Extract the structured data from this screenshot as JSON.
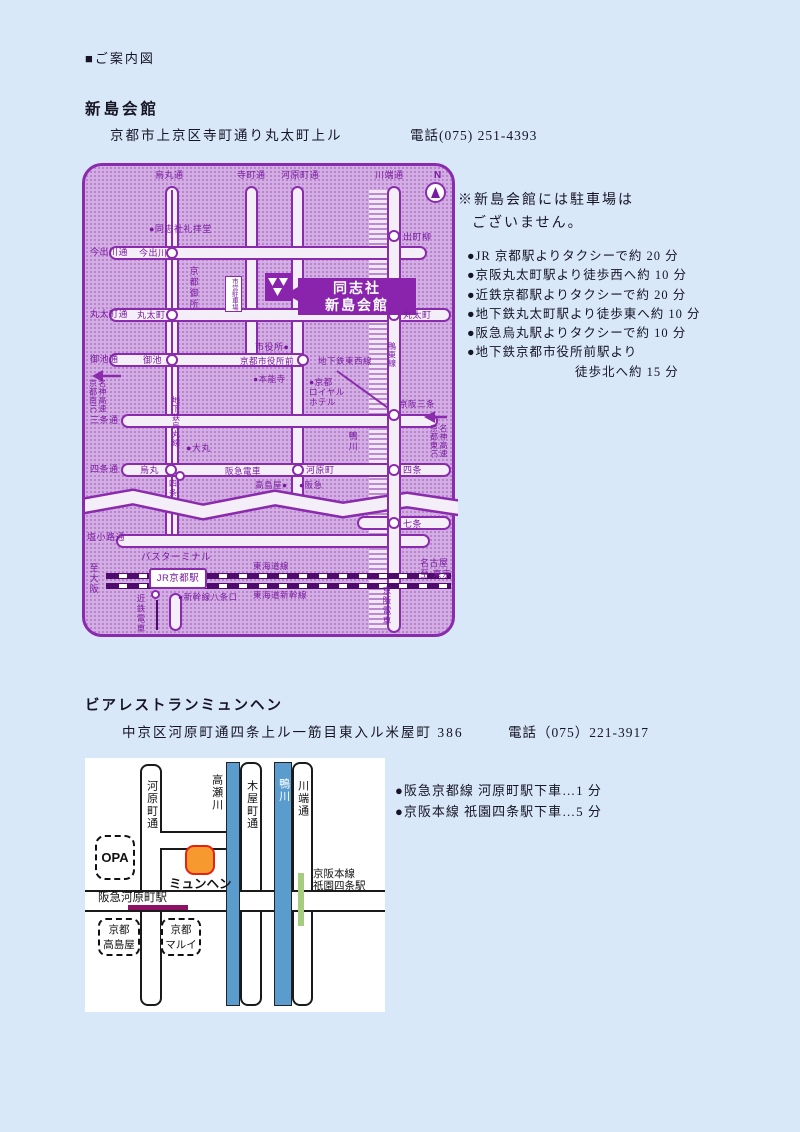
{
  "doc": {
    "heading": "■ご案内図",
    "s1_title": "新島会館",
    "s1_address": "京都市上京区寺町通り丸太町上ル",
    "s1_phone": "電話(075) 251-4393",
    "s1_note1": "※新島会館には駐車場は",
    "s1_note2": "ございません。",
    "s1_access": [
      "●JR 京都駅よりタクシーで約 20 分",
      "●京阪丸太町駅より徒歩西へ約 10 分",
      "●近鉄京都駅よりタクシーで約 20 分",
      "●地下鉄丸太町駅より徒歩東へ約 10 分",
      "●阪急烏丸駅よりタクシーで約 10 分",
      "●地下鉄京都市役所前駅より",
      "徒歩北へ約 15 分"
    ],
    "s2_title": "ビアレストランミュンヘン",
    "s2_address": "中京区河原町通四条上ル一筋目東入ル米屋町 386",
    "s2_phone": "電話（075）221-3917",
    "s2_access": [
      "●阪急京都線 河原町駅下車…1 分",
      "●京阪本線 祇園四条駅下車…5 分"
    ]
  },
  "map1": {
    "compass": "N",
    "venue_line1": "同志社",
    "venue_line2": "新島会館",
    "streets_top": {
      "karasuma": "烏丸通",
      "teramachi": "寺町通",
      "kawaramachi": "河原町通",
      "kawabata": "川端通"
    },
    "streets_left": {
      "imadegawa": "今出川通",
      "marutamachi": "丸太町通",
      "oike": "御池通",
      "sanjo": "三条通",
      "shijo": "四条通",
      "shiokoji": "塩小路通"
    },
    "stations": {
      "imadegawa": "今出川",
      "marutamachi_w": "丸太町",
      "oike": "御池",
      "karasuma": "烏丸",
      "shijo_subway": "四条",
      "kawaramachi": "河原町",
      "shiyakushomae": "京都市役所前",
      "demachiyanagi": "出町柳",
      "marutamachi_e": "丸太町",
      "keihan_sanjo": "京阪三条",
      "shijo_e": "四条",
      "shichijo": "七条"
    },
    "lines": {
      "tozai": "地下鉄東西線",
      "karasuma_subway": "地下鉄烏丸線",
      "oto": "鴨東線",
      "hankyu": "阪急電車",
      "tokaido": "東海道線",
      "shinkansen": "東海道新幹線",
      "kintetsu": "近鉄電車",
      "keihan": "京阪電車"
    },
    "pois": {
      "chapel": "●同志社礼拝堂",
      "gosho": "京都御所",
      "parking": "市営駐車場",
      "cityhall": "市役所●",
      "honnoji": "●本能寺",
      "royal_hotel": "●京都\nロイヤル\nホテル",
      "daimaru": "●大丸",
      "takashimaya": "高島屋●",
      "hankyu_dept": "●阪急",
      "kamogawa": "鴨川",
      "bus_terminal": "バスターミナル",
      "jr_kyoto": "JR京都駅",
      "hachijo": "●新幹線八条口"
    },
    "edges": {
      "to_osaka": "至大阪",
      "to_tokyo": "名古屋\n至 東京",
      "meishin_s": "名神高速\n京都南IC",
      "meishin_e": "名神高速\n京都東IC"
    }
  },
  "map2": {
    "streets": {
      "kawaramachi": "河原町通",
      "kiyamachi": "木屋町通",
      "kawabata": "川端通"
    },
    "rivers": {
      "takase": "高瀬川",
      "kamo": "鴨川"
    },
    "pois": {
      "opa": "OPA",
      "munchen": "ミュンヘン",
      "hankyu_station": "阪急河原町駅",
      "takashimaya": "京都\n高島屋",
      "marui": "京都\nマルイ",
      "keihan_station": "京阪本線\n祇園四条駅"
    }
  },
  "colors": {
    "purple_line": "#8a2bad",
    "map_bg": "#d3aee2",
    "venue_bg": "#8a24ad",
    "rail_dark": "#4f0b6b",
    "river_blue": "#5b9ccf",
    "keihan_green": "#a5cc7f",
    "hankyu_maroon": "#8e1166",
    "marker_orange": "#f6992f",
    "marker_red": "#e42313"
  }
}
